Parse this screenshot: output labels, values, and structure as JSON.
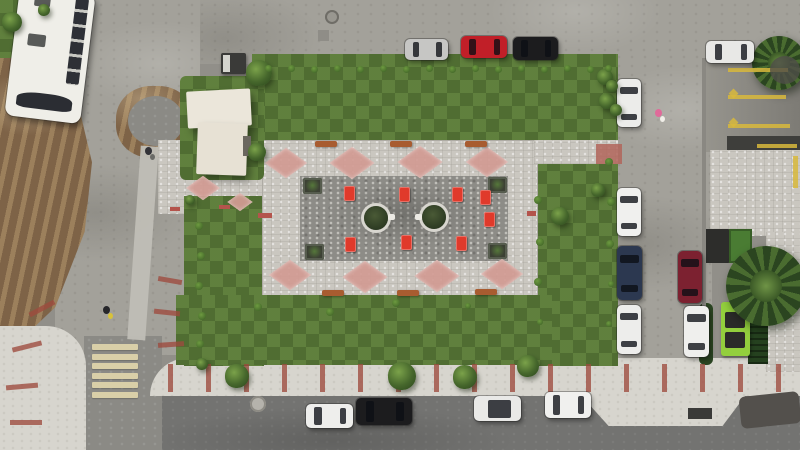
{
  "scene": {
    "kind": "aerial-drone-photo",
    "subject": "new rectangular park plaza with lawns, paved court, surrounding streets, parked vehicles",
    "colors": {
      "grass": "#5a7a3a",
      "plaza_light": "#cac7c0",
      "plaza_dark": "#8d8c87",
      "diamond_pink": "#d29b93",
      "furniture_red": "#e03a2b",
      "bench_orange": "#a85c30",
      "concrete": "#a3a19a",
      "asphalt": "#737371",
      "sidewalk": "#d7d5ce",
      "dirt": "#7e6347",
      "dumpster_green": "#93cf3d",
      "crosswalk_cream": "#d9cfa8",
      "curb_red": "#9e4a3e",
      "marking_yellow": "#d8b93c",
      "bus_white": "#efeee8"
    },
    "counts": {
      "parked_cars": 14,
      "buses": 1,
      "tree_circles": 2,
      "corner_planters": 4,
      "pink_diamonds": 10,
      "red_furniture_sets": 8,
      "benches": 6,
      "crosswalk_bars": 6
    }
  },
  "cars": [
    {
      "x": 405,
      "y": 39,
      "w": 43,
      "h": 21,
      "c": "#c6c6c4",
      "o": "h"
    },
    {
      "x": 461,
      "y": 36,
      "w": 46,
      "h": 22,
      "c": "#c11f28",
      "o": "h"
    },
    {
      "x": 513,
      "y": 37,
      "w": 45,
      "h": 23,
      "c": "#1c1c1e",
      "o": "h"
    },
    {
      "x": 706,
      "y": 41,
      "w": 48,
      "h": 22,
      "c": "#e8e8e6",
      "o": "h"
    },
    {
      "x": 617,
      "y": 79,
      "w": 24,
      "h": 48,
      "c": "#ececea",
      "o": "v"
    },
    {
      "x": 617,
      "y": 188,
      "w": 24,
      "h": 48,
      "c": "#f0f0ee",
      "o": "v"
    },
    {
      "x": 617,
      "y": 246,
      "w": 25,
      "h": 54,
      "c": "#2c3850",
      "o": "v"
    },
    {
      "x": 617,
      "y": 305,
      "w": 24,
      "h": 49,
      "c": "#ededeb",
      "o": "v"
    },
    {
      "x": 678,
      "y": 251,
      "w": 24,
      "h": 52,
      "c": "#7c2130",
      "o": "v"
    },
    {
      "x": 684,
      "y": 306,
      "w": 25,
      "h": 51,
      "c": "#efefed",
      "o": "v"
    },
    {
      "x": 306,
      "y": 404,
      "w": 47,
      "h": 24,
      "c": "#eeeeec",
      "o": "h"
    },
    {
      "x": 356,
      "y": 398,
      "w": 56,
      "h": 27,
      "c": "#1c1c1e",
      "o": "h"
    },
    {
      "x": 474,
      "y": 396,
      "w": 47,
      "h": 25,
      "c": "#e9e9e7",
      "o": "h",
      "roof": true
    },
    {
      "x": 545,
      "y": 392,
      "w": 46,
      "h": 26,
      "c": "#f0f0ee",
      "o": "h"
    }
  ],
  "trees": [
    [
      259,
      73,
      13
    ],
    [
      257,
      152,
      9
    ],
    [
      237,
      376,
      12
    ],
    [
      402,
      376,
      14
    ],
    [
      465,
      377,
      12
    ],
    [
      528,
      366,
      11
    ],
    [
      560,
      216,
      9
    ],
    [
      605,
      77,
      8
    ],
    [
      607,
      101,
      8
    ],
    [
      598,
      190,
      7
    ],
    [
      202,
      364,
      6
    ],
    [
      12,
      22,
      10
    ],
    [
      44,
      10,
      6
    ],
    [
      612,
      86,
      6
    ],
    [
      616,
      110,
      6
    ],
    [
      190,
      200,
      5
    ]
  ],
  "shrubs": [
    [
      268,
      68,
      3.5
    ],
    [
      291,
      68,
      3.5
    ],
    [
      314,
      69,
      3.5
    ],
    [
      337,
      68,
      3.5
    ],
    [
      360,
      69,
      3.5
    ],
    [
      383,
      68,
      3.5
    ],
    [
      406,
      69,
      3.5
    ],
    [
      429,
      68,
      3.5
    ],
    [
      452,
      69,
      3.5
    ],
    [
      475,
      68,
      3.5
    ],
    [
      498,
      69,
      3.5
    ],
    [
      521,
      68,
      3.5
    ],
    [
      544,
      69,
      3.5
    ],
    [
      567,
      68,
      3.5
    ],
    [
      590,
      69,
      3.5
    ],
    [
      608,
      68,
      3.5
    ],
    [
      199,
      226,
      4
    ],
    [
      201,
      256,
      4
    ],
    [
      199,
      286,
      4
    ],
    [
      202,
      316,
      4
    ],
    [
      200,
      344,
      4
    ],
    [
      538,
      200,
      4
    ],
    [
      540,
      242,
      4
    ],
    [
      538,
      282,
      4
    ],
    [
      540,
      322,
      3
    ],
    [
      609,
      162,
      4
    ],
    [
      611,
      202,
      4
    ],
    [
      610,
      244,
      4
    ],
    [
      611,
      284,
      3
    ],
    [
      609,
      324,
      3
    ],
    [
      258,
      307,
      4
    ],
    [
      330,
      312,
      4
    ],
    [
      396,
      303,
      4
    ],
    [
      468,
      306,
      3
    ]
  ],
  "diamonds": [
    [
      286,
      163,
      30
    ],
    [
      352,
      163,
      32
    ],
    [
      420,
      162,
      32
    ],
    [
      487,
      162,
      30
    ],
    [
      290,
      275,
      30
    ],
    [
      365,
      277,
      32
    ],
    [
      437,
      276,
      32
    ],
    [
      502,
      274,
      30
    ],
    [
      203,
      188,
      24
    ],
    [
      240,
      202,
      18
    ]
  ],
  "furniture": [
    [
      344,
      186
    ],
    [
      399,
      187
    ],
    [
      452,
      187
    ],
    [
      345,
      237
    ],
    [
      401,
      235
    ],
    [
      456,
      236
    ],
    [
      480,
      190
    ],
    [
      484,
      212
    ]
  ],
  "white_seats": [
    [
      388,
      214
    ],
    [
      415,
      214
    ]
  ],
  "benches": [
    [
      315,
      141,
      22,
      6
    ],
    [
      390,
      141,
      22,
      6
    ],
    [
      465,
      141,
      22,
      6
    ],
    [
      322,
      290,
      22,
      6
    ],
    [
      397,
      290,
      22,
      6
    ],
    [
      475,
      289,
      22,
      6
    ]
  ],
  "planters": [
    [
      303,
      178
    ],
    [
      488,
      177
    ],
    [
      305,
      244
    ],
    [
      488,
      243
    ]
  ],
  "tree_circles": [
    [
      376,
      218,
      12
    ],
    [
      434,
      217,
      12
    ]
  ],
  "red_strips": [
    {
      "x": 168,
      "y": 364,
      "w": 5,
      "h": 28
    },
    {
      "x": 206,
      "y": 364,
      "w": 5,
      "h": 28
    },
    {
      "x": 244,
      "y": 364,
      "w": 5,
      "h": 28
    },
    {
      "x": 282,
      "y": 364,
      "w": 5,
      "h": 28
    },
    {
      "x": 320,
      "y": 364,
      "w": 5,
      "h": 28
    },
    {
      "x": 358,
      "y": 364,
      "w": 5,
      "h": 28
    },
    {
      "x": 396,
      "y": 364,
      "w": 5,
      "h": 28
    },
    {
      "x": 434,
      "y": 364,
      "w": 5,
      "h": 28
    },
    {
      "x": 472,
      "y": 364,
      "w": 5,
      "h": 28
    },
    {
      "x": 510,
      "y": 364,
      "w": 5,
      "h": 28
    },
    {
      "x": 548,
      "y": 364,
      "w": 5,
      "h": 28
    },
    {
      "x": 586,
      "y": 364,
      "w": 5,
      "h": 28
    },
    {
      "x": 624,
      "y": 364,
      "w": 5,
      "h": 28
    },
    {
      "x": 662,
      "y": 364,
      "w": 5,
      "h": 28
    },
    {
      "x": 700,
      "y": 364,
      "w": 5,
      "h": 28
    },
    {
      "x": 738,
      "y": 364,
      "w": 5,
      "h": 28
    },
    {
      "x": 776,
      "y": 364,
      "w": 5,
      "h": 28
    },
    {
      "x": 158,
      "y": 278,
      "w": 24,
      "h": 5,
      "rot": 10
    },
    {
      "x": 154,
      "y": 310,
      "w": 26,
      "h": 5,
      "rot": 6
    },
    {
      "x": 158,
      "y": 342,
      "w": 26,
      "h": 5,
      "rot": -4
    },
    {
      "x": 28,
      "y": 306,
      "w": 28,
      "h": 5,
      "rot": -28
    },
    {
      "x": 12,
      "y": 344,
      "w": 30,
      "h": 5,
      "rot": -14
    },
    {
      "x": 6,
      "y": 384,
      "w": 32,
      "h": 5,
      "rot": -5
    },
    {
      "x": 10,
      "y": 420,
      "w": 32,
      "h": 5,
      "rot": 0
    },
    {
      "x": 258,
      "y": 213,
      "w": 14,
      "h": 5,
      "c": "#b4544c"
    },
    {
      "x": 527,
      "y": 211,
      "w": 9,
      "h": 5,
      "c": "#b4544c"
    },
    {
      "x": 219,
      "y": 205,
      "w": 11,
      "h": 4,
      "c": "#b4544c"
    },
    {
      "x": 170,
      "y": 207,
      "w": 10,
      "h": 4,
      "c": "#b4544c"
    }
  ],
  "crosswalk": {
    "x": 92,
    "y": 344,
    "bars": 6,
    "w": 46,
    "h": 6,
    "gap": 3.5
  },
  "people": [
    {
      "x": 655,
      "y": 109,
      "c": "#e06a9a",
      "c2": "#f0eee8"
    },
    {
      "x": 103,
      "y": 306,
      "c": "#26262a",
      "c2": "#d8c23a"
    },
    {
      "x": 145,
      "y": 147,
      "c": "#333338",
      "c2": "#6a6a66"
    }
  ],
  "yellow_marks": [
    {
      "x": 728,
      "y": 68,
      "w": 60,
      "h": 4
    },
    {
      "x": 728,
      "y": 95,
      "w": 58,
      "h": 4
    },
    {
      "x": 728,
      "y": 124,
      "w": 62,
      "h": 4
    },
    {
      "x": 757,
      "y": 144,
      "w": 40,
      "h": 4
    },
    {
      "x": 793,
      "y": 156,
      "w": 5,
      "h": 32
    },
    {
      "x": 730,
      "y": 90,
      "w": 7,
      "h": 7,
      "rot": 45
    },
    {
      "x": 730,
      "y": 119,
      "w": 7,
      "h": 7,
      "rot": 45
    }
  ],
  "patches": [
    {
      "x": 596,
      "y": 144,
      "w": 26,
      "h": 20,
      "bg": "#b2655a",
      "op": 0.85
    },
    {
      "x": 688,
      "y": 408,
      "w": 24,
      "h": 11,
      "bg": "#3a3a38"
    },
    {
      "x": 740,
      "y": 394,
      "w": 60,
      "h": 32,
      "bg": "#53504c",
      "rot": -6,
      "br": "6px"
    },
    {
      "x": 325,
      "y": 10,
      "w": 14,
      "h": 14,
      "bg": "#999790",
      "br": "50%",
      "ring": "#6f6d67"
    },
    {
      "x": 250,
      "y": 396,
      "w": 16,
      "h": 16,
      "bg": "#b5b3ac",
      "br": "50%",
      "ring": "#8d8b84"
    },
    {
      "x": 318,
      "y": 30,
      "w": 11,
      "h": 11,
      "bg": "#8f8d87"
    },
    {
      "x": 243,
      "y": 136,
      "w": 8,
      "h": 20,
      "bg": "#6b675f"
    },
    {
      "x": 223,
      "y": 55,
      "w": 7,
      "h": 17,
      "bg": "#d5d5cf"
    },
    {
      "x": 770,
      "y": 56,
      "w": 30,
      "h": 28,
      "bg": "#4f4d49",
      "br": "50%",
      "op": 0.8
    },
    {
      "x": 702,
      "y": 58,
      "w": 4,
      "h": 254,
      "bg": "#8a8882"
    }
  ]
}
